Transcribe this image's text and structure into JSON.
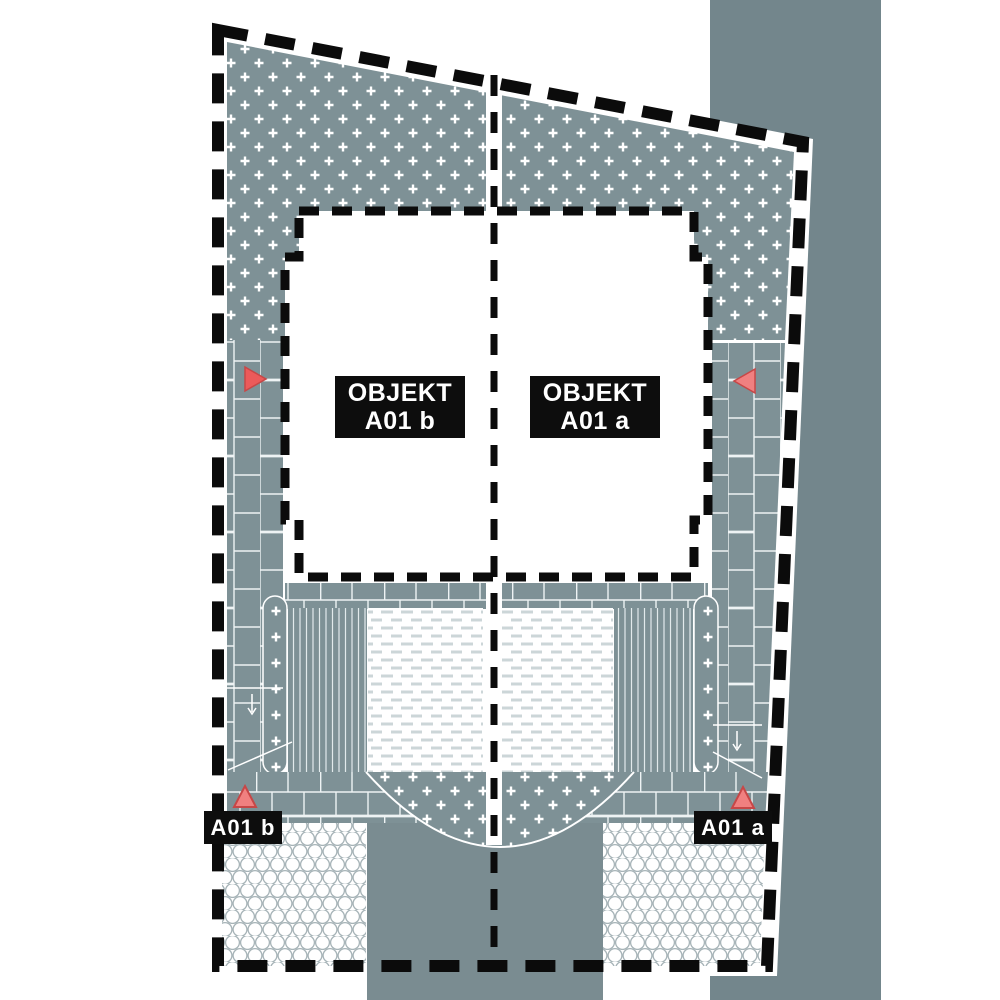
{
  "document": {
    "type": "architectural-site-plan",
    "sheet_background": "#ffffff"
  },
  "labels": {
    "objekt_b": {
      "line1": "OBJEKT",
      "line2": "A01 b"
    },
    "objekt_a": {
      "line1": "OBJEKT",
      "line2": "A01 a"
    },
    "entrance_b": "A01 b",
    "entrance_a": "A01 a"
  },
  "markers": {
    "west_side_arrow_direction": "right",
    "east_side_arrow_direction": "left",
    "entrance_b_arrow_direction": "up",
    "entrance_a_arrow_direction": "up"
  },
  "colors": {
    "street_band": "#73868c",
    "paving": "#7e9196",
    "road": "#7a8c91",
    "paving_joint": "#eef3f4",
    "hex_outline": "#a7b4b8",
    "patio_dash": "#ccd6d8",
    "plan_outline": "#0b0b0b",
    "label_background": "#0d0d0d",
    "label_text": "#ffffff",
    "marker_fill": "#f08080",
    "marker_stroke": "#c74747",
    "side_marker_fill": "#ec5a5a"
  }
}
